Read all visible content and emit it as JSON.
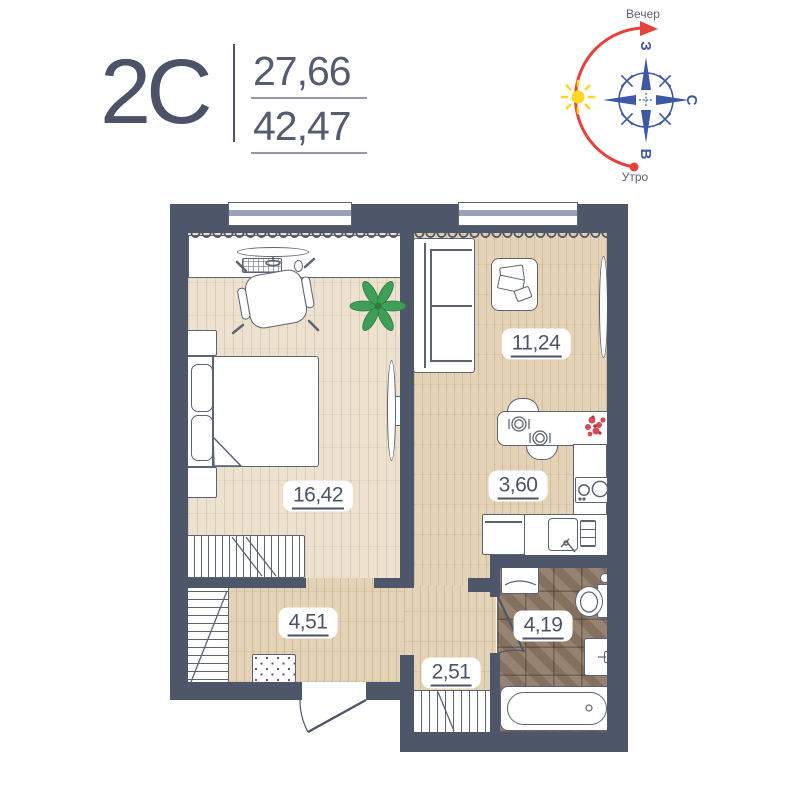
{
  "header": {
    "plan_type": "2С",
    "area_living": "27,66",
    "area_total": "42,47"
  },
  "compass": {
    "label_evening": "Вечер",
    "label_morning": "Утро",
    "dir_west": "З",
    "dir_north": "С",
    "dir_east": "В",
    "blue": "#3f57a7",
    "red": "#e8413c",
    "sun_yellow": "#ffd824"
  },
  "rooms": {
    "bedroom": {
      "area": "16,42"
    },
    "living": {
      "area": "11,24"
    },
    "kitchen": {
      "area": "3,60"
    },
    "corridor": {
      "area": "4,51"
    },
    "hallway": {
      "area": "2,51"
    },
    "bathroom": {
      "area": "4,19"
    }
  },
  "colors": {
    "wall": "#4e5669",
    "accent_text": "#4c5368",
    "floor_light": "#ece2cf",
    "floor_warm": "#e4d3b6",
    "bath_tile": "#8f7a66",
    "furniture_outline": "#5c6373"
  }
}
